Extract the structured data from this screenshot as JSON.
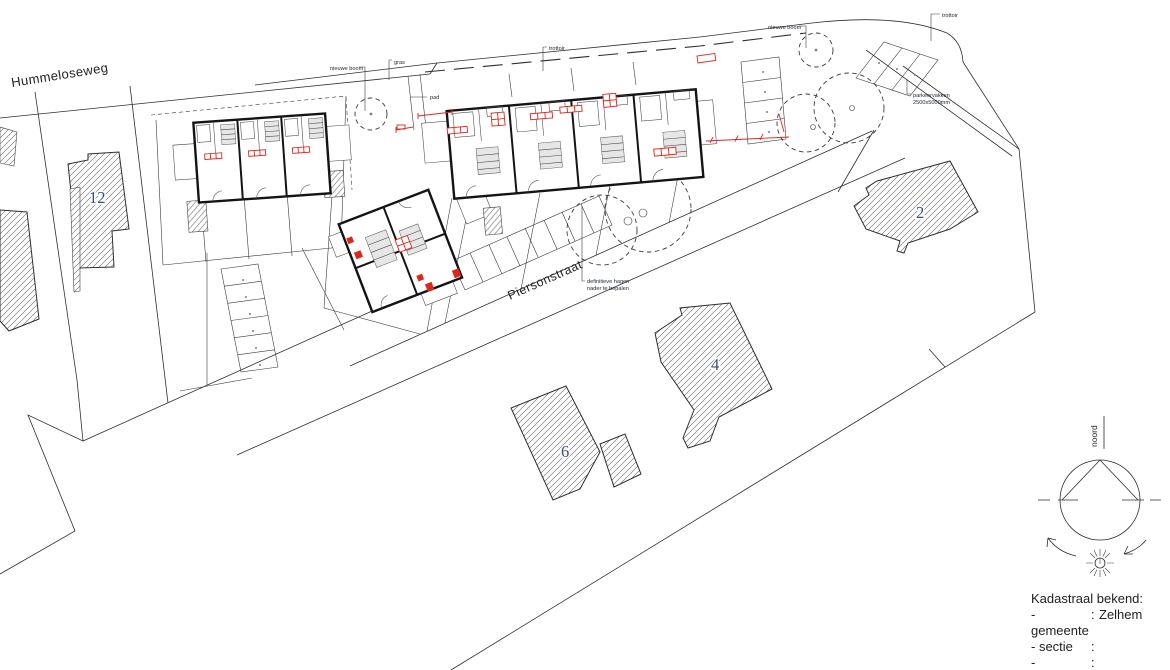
{
  "drawing": {
    "streets": {
      "hummeloseweg": "Hummeloseweg",
      "piersonstraat": "Piersonstraat"
    },
    "labels": {
      "nieuwe_boom_1": "nieuwe boom",
      "gras": "gras",
      "trottoir_center": "trottoir",
      "pad": "pad",
      "nieuwe_boom_2": "nieuwe boom",
      "trottoir_right": "trottoir",
      "parkeervakken_1": "parkeervakken",
      "parkeervakken_2": "2500x5000mm",
      "hagen_1": "definitieve hagen",
      "hagen_2": "nader te bepalen"
    },
    "houses": [
      {
        "number": "12"
      },
      {
        "number": "2"
      },
      {
        "number": "4"
      },
      {
        "number": "6"
      }
    ],
    "compass": {
      "north_label": "noord"
    },
    "legend": {
      "title": "Kadastraal bekend:",
      "rows": [
        {
          "label": "- gemeente",
          "sep": ":",
          "value": "Zelhem"
        },
        {
          "label": "- sectie",
          "sep": ":",
          "value": ""
        },
        {
          "label": "- nummer(s)",
          "sep": ":",
          "value": ""
        }
      ]
    },
    "colors": {
      "accent_red": "#e0251b",
      "ink": "#1d1d1b",
      "number_ink": "#37507a"
    }
  }
}
